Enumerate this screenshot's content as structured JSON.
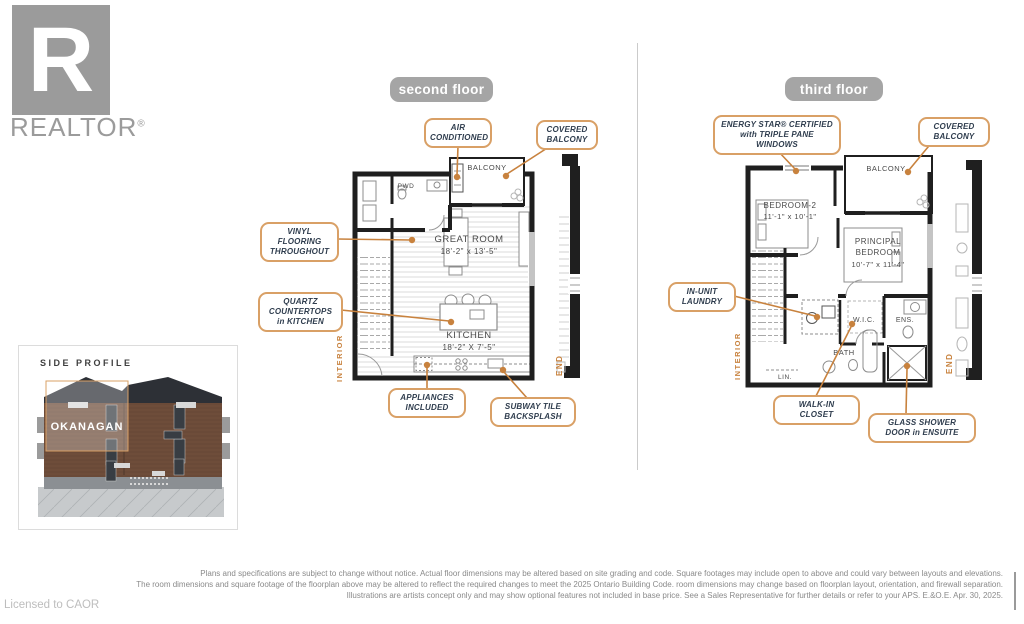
{
  "brand": {
    "logo_letter": "R",
    "logo_name": "REALTOR",
    "registered": "®"
  },
  "footer": {
    "licensed_to": "Licensed to CAOR",
    "disclaimer": [
      "Plans and specifications are subject to change without notice. Actual floor dimensions may be altered based on site grading and code. Square footages may include open to above and could vary between layouts and elevations.",
      "The room dimensions and square footage of the floorplan above may be altered to reflect the required changes to meet the 2025 Ontario Building Code. room dimensions may change based on floorplan layout, orientation, and firewall separation.",
      "Illustrations are artists concept only and may show optional features not included in base price. See a Sales Representative for further details or refer to your APS. E.&O.E. Apr. 30, 2025."
    ]
  },
  "side_profile": {
    "title": "SIDE PROFILE",
    "model": "OKANAGAN"
  },
  "floors": {
    "second": {
      "badge": "second floor",
      "callouts": {
        "air_conditioned": [
          "AIR",
          "CONDITIONED"
        ],
        "covered_balcony": [
          "COVERED",
          "BALCONY"
        ],
        "vinyl_flooring": [
          "VINYL",
          "FLOORING",
          "THROUGHOUT"
        ],
        "quartz_countertops": [
          "QUARTZ",
          "COUNTERTOPS",
          "in KITCHEN"
        ],
        "appliances_included": [
          "APPLIANCES",
          "INCLUDED"
        ],
        "subway_tile": [
          "SUBWAY TILE",
          "BACKSPLASH"
        ]
      },
      "rooms": {
        "balcony": "BALCONY",
        "pwd": "PWD",
        "great_room": "GREAT ROOM",
        "great_room_dims": "18'-2\" x 13'-5\"",
        "kitchen": "KITCHEN",
        "kitchen_dims": "18'-2\" X 7'-5\""
      },
      "edge_labels": {
        "interior": "INTERIOR",
        "end": "END"
      }
    },
    "third": {
      "badge": "third floor",
      "callouts": {
        "energy_star": [
          "ENERGY STAR® CERTIFIED",
          "with TRIPLE PANE",
          "WINDOWS"
        ],
        "covered_balcony": [
          "COVERED",
          "BALCONY"
        ],
        "in_unit_laundry": [
          "IN-UNIT",
          "LAUNDRY"
        ],
        "walk_in_closet": [
          "WALK-IN",
          "CLOSET"
        ],
        "glass_shower": [
          "GLASS SHOWER",
          "DOOR in ENSUITE"
        ]
      },
      "rooms": {
        "balcony": "BALCONY",
        "bedroom2": "BEDROOM-2",
        "bedroom2_dims": "11'-1\" x 10'-1\"",
        "principal_1": "PRINCIPAL",
        "principal_2": "BEDROOM",
        "principal_dims": "10'-7\" x 11'-4\"",
        "wic": "W.I.C.",
        "ens": "ENS.",
        "bath": "BATH",
        "lin": "LIN."
      },
      "edge_labels": {
        "interior": "INTERIOR",
        "end": "END"
      }
    }
  },
  "colors": {
    "accent_border": "#D9A066",
    "leader": "#C8823E",
    "badge_bg": "#A5A5A5",
    "callout_text": "#2F3D4E",
    "wall": "#1F1F1F",
    "logo_gray": "#9B9B9B"
  }
}
